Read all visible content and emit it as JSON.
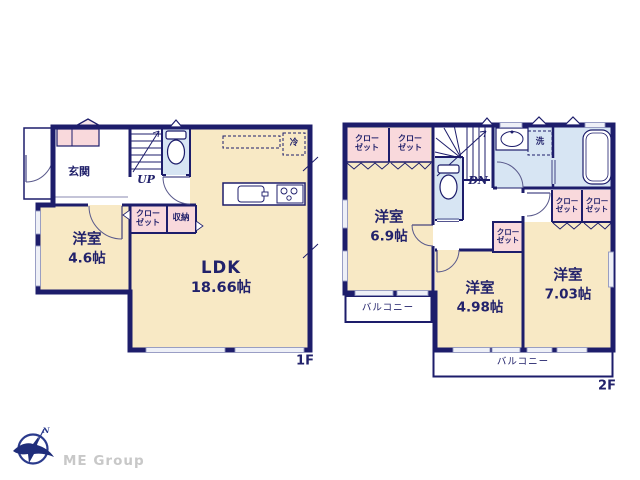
{
  "palette": {
    "wall_navy": "#1d1d6b",
    "room_beige": "#f8e9c5",
    "closet_pink": "#f9d9dc",
    "sanitary_blue": "#d7e5f3",
    "window_light": "#eef0f7",
    "logo_gray": "#c8c8c8"
  },
  "floor1": {
    "floor_label": "1F",
    "entrance": {
      "label": "玄関"
    },
    "bedroom": {
      "label": "洋室",
      "size": "4.6帖"
    },
    "ldk": {
      "label": "LDK",
      "size": "18.66帖"
    },
    "closet": {
      "line1": "クロー",
      "line2": "ゼット"
    },
    "storage": {
      "label": "収納"
    },
    "stairs": {
      "label": "UP"
    },
    "fridge": {
      "label": "冷"
    }
  },
  "floor2": {
    "floor_label": "2F",
    "bedroom_a": {
      "label": "洋室",
      "size": "6.9帖"
    },
    "bedroom_b": {
      "label": "洋室",
      "size": "4.98帖"
    },
    "bedroom_c": {
      "label": "洋室",
      "size": "7.03帖"
    },
    "closet": {
      "line1": "クロー",
      "line2": "ゼット"
    },
    "stairs": {
      "label": "DN"
    },
    "laundry": {
      "label": "洗"
    },
    "balcony": {
      "label": "バルコニー"
    }
  },
  "logo": {
    "company": "ME Group",
    "north": "N"
  },
  "icons": {
    "toilet": "toilet-icon",
    "bathtub": "bathtub-icon",
    "vanity": "vanity-sink-icon",
    "kitchen_sink": "kitchen-sink-icon",
    "stove": "stove-icon",
    "fridge_box": "fridge-dashed-box",
    "stairs_up": "stairs-up-icon",
    "stairs_down": "stairs-down-icon",
    "compass": "compass-north-icon"
  }
}
